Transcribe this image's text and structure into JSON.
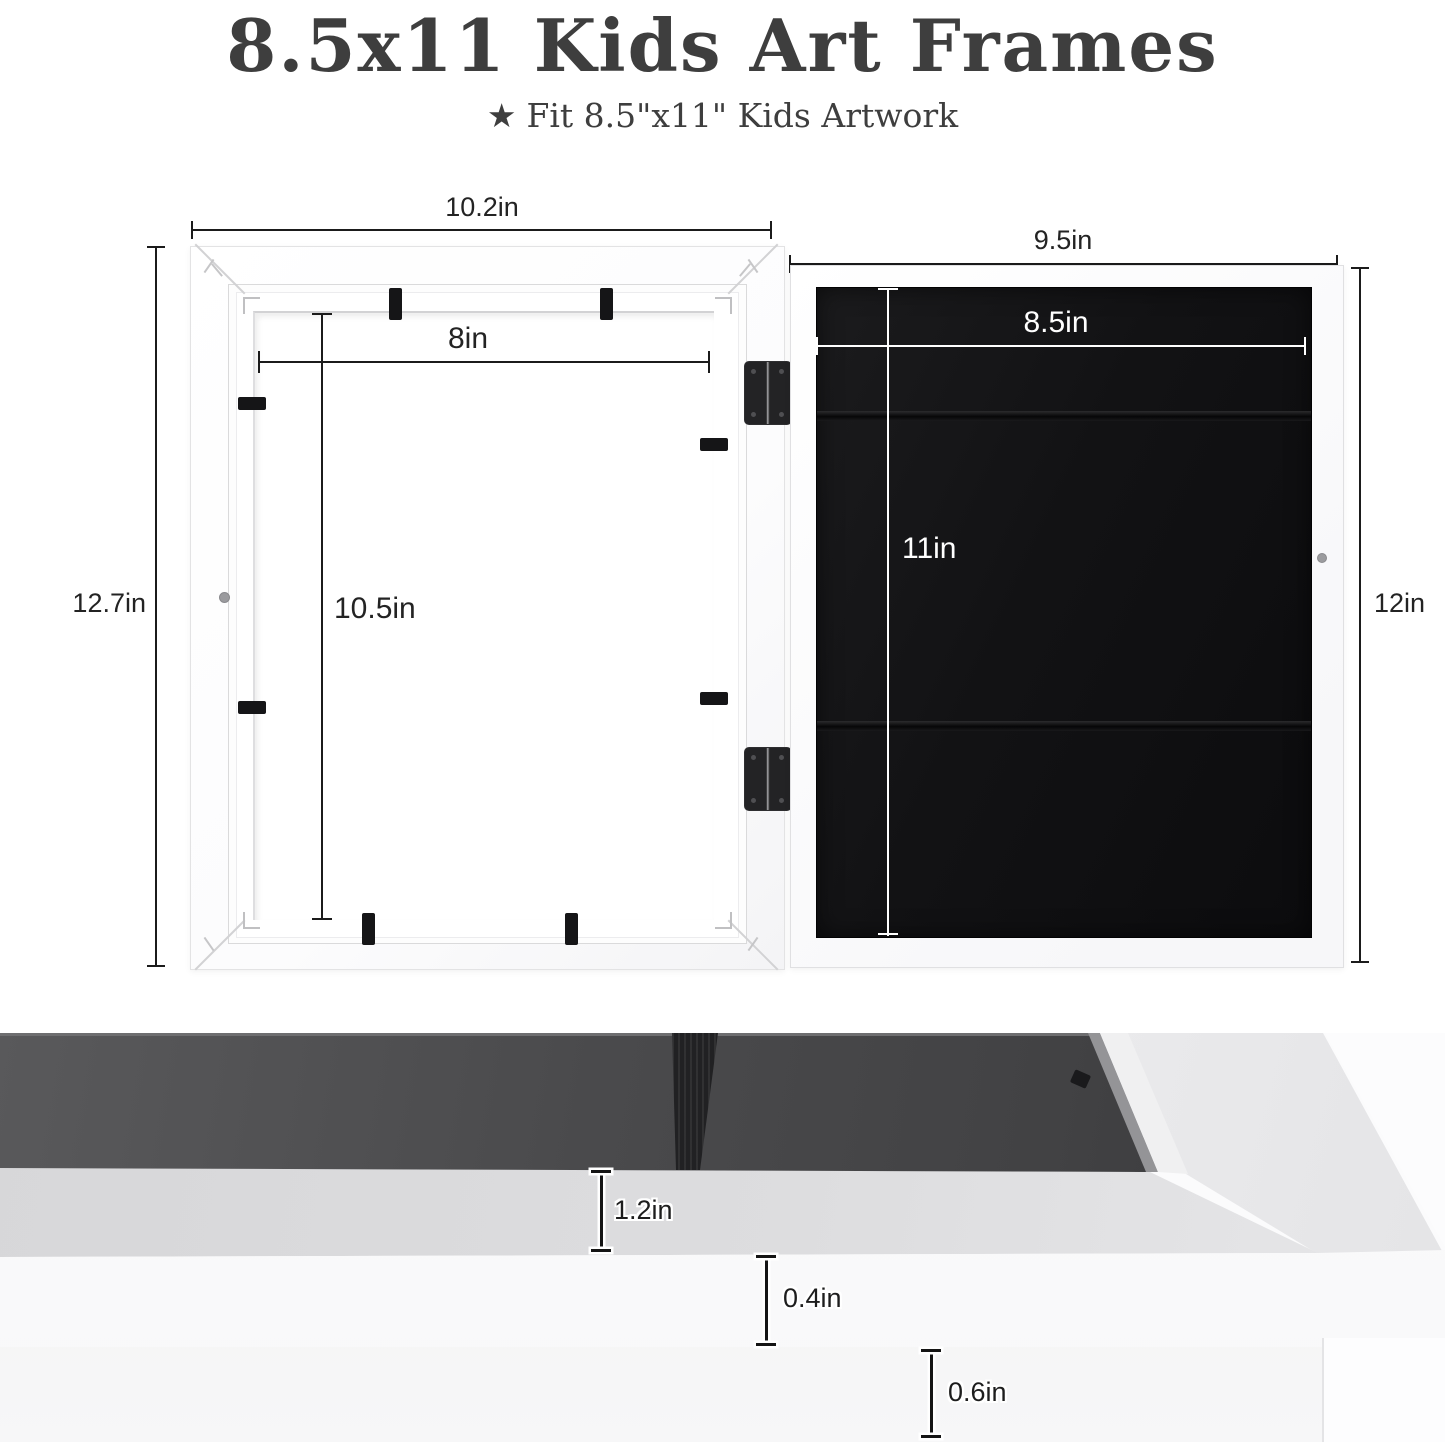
{
  "header": {
    "title": "8.5x11 Kids Art Frames",
    "star": "★",
    "subtitle": "Fit 8.5\"x11\" Kids Artwork"
  },
  "front_frame": {
    "outer_width": "10.2in",
    "outer_height": "12.7in",
    "opening_width": "8in",
    "opening_height": "10.5in"
  },
  "back_frame": {
    "outer_width": "9.5in",
    "outer_height": "12in",
    "art_width": "8.5in",
    "art_height": "11in"
  },
  "profile": {
    "depth": "1.2in",
    "face": "0.4in",
    "edge": "0.6in"
  },
  "colors": {
    "text": "#3e3e3e",
    "dimension_line": "#1b1b1b",
    "frame_white": "#ffffff",
    "backing_black": "#121214"
  }
}
